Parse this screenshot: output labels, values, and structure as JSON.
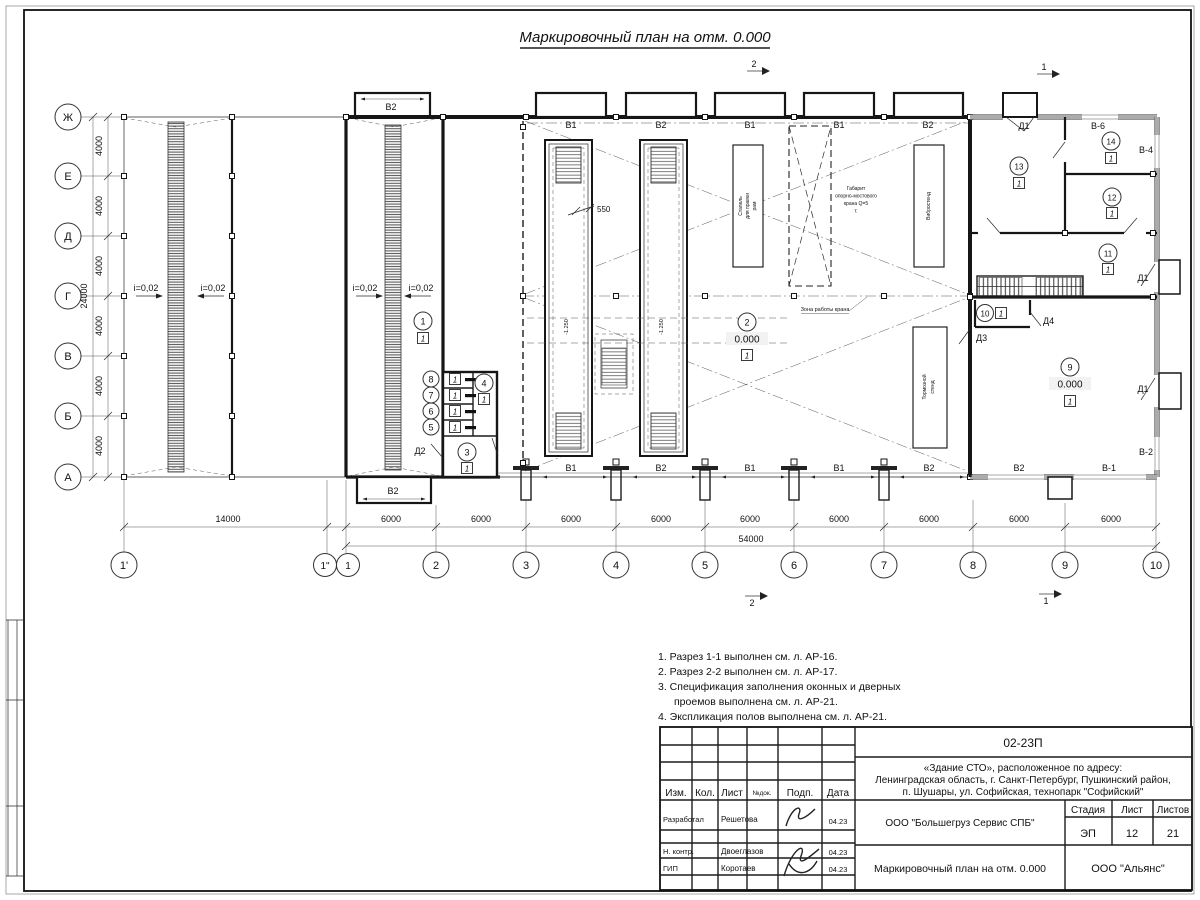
{
  "sheet": {
    "title": "Маркировочный план на отм. 0.000"
  },
  "axes": {
    "cols": [
      "1'",
      "1\"",
      "1",
      "2",
      "3",
      "4",
      "5",
      "6",
      "7",
      "8",
      "9",
      "10"
    ],
    "col_dims": [
      "14000",
      "6000",
      "6000",
      "6000",
      "6000",
      "6000",
      "6000",
      "6000",
      "6000",
      "6000"
    ],
    "col_total": "54000",
    "rows": [
      "Ж",
      "Е",
      "Д",
      "Г",
      "В",
      "Б",
      "А"
    ],
    "row_dims": [
      "4000",
      "4000",
      "4000",
      "4000",
      "4000",
      "4000"
    ],
    "row_total": "24000"
  },
  "plan": {
    "slope": "i=0,02",
    "dim_550": "550",
    "elev_zero": "0.000",
    "elev_pit": "-1.250",
    "zone_label": "Зона работы крана",
    "crane_lines": [
      "Габарит",
      "опорно-мостового",
      "крана Q=5",
      "т."
    ],
    "equipment": {
      "stapel": [
        "Стапель",
        "для правки",
        "рам"
      ],
      "vibro": "Вибростенд",
      "tormoz": [
        "Тормозной",
        "стенд"
      ]
    },
    "rooms": [
      "1",
      "2",
      "3",
      "4",
      "5",
      "6",
      "7",
      "8",
      "9",
      "10",
      "11",
      "12",
      "13",
      "14"
    ],
    "floor_type": "1",
    "doors": {
      "d1": "Д1",
      "d2": "Д2",
      "d3": "Д3",
      "d4": "Д4"
    },
    "openings": {
      "top": [
        "В1",
        "В2",
        "В1",
        "В1",
        "В2"
      ],
      "bottom": [
        "В1",
        "В2",
        "В1",
        "В1",
        "В2",
        "В2",
        "В-1"
      ],
      "annex_top": "В2",
      "annex_bottom": "В2",
      "v6": "В-6",
      "v4": "В-4",
      "v2": "В-2"
    },
    "section_marks": {
      "s1": "1",
      "s2": "2"
    }
  },
  "notes": [
    "1. Разрез 1-1 выполнен см. л. АР-16.",
    "2. Разрез 2-2 выполнен см. л. АР-17.",
    "3. Спецификация заполнения оконных и дверных",
    "проемов выполнена см. л. АР-21.",
    "4. Экспликация полов выполнена см. л. АР-21."
  ],
  "titleblock": {
    "doc_number": "02-23П",
    "project": [
      "«Здание СТО», расположенное по адресу:",
      "Ленинградская область, г. Санкт-Петербург, Пушкинский район,",
      "п. Шушары, ул. Софийская, технопарк \"Софийский\""
    ],
    "header_cols": [
      "Изм.",
      "Кол.",
      "Лист",
      "№док.",
      "Подп.",
      "Дата"
    ],
    "signers": [
      {
        "role": "Разработал",
        "name": "Решетова",
        "date": "04.23"
      },
      {
        "role": "Н. контр.",
        "name": "Двоеглазов",
        "date": "04.23"
      },
      {
        "role": "ГИП",
        "name": "Коротаев",
        "date": "04.23"
      }
    ],
    "client": "ООО \"Большегруз Сервис СПБ\"",
    "stage_label": "Стадия",
    "sheet_label": "Лист",
    "sheets_label": "Листов",
    "stage": "ЭП",
    "sheet_no": "12",
    "sheets_total": "21",
    "drawing_name": "Маркировочный план на отм. 0.000",
    "company": "ООО \"Альянс\""
  }
}
